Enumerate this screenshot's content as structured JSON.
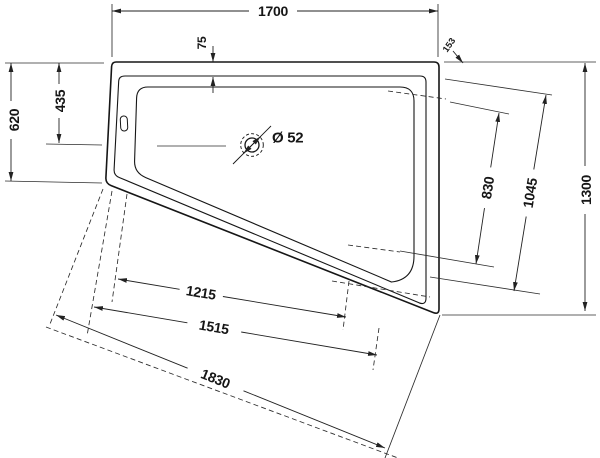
{
  "drawing": {
    "title": "bathtub-plan-technical-drawing",
    "background": "#ffffff",
    "line_color": "#161616",
    "dims": {
      "width_top": "1700",
      "rim_offset": "75",
      "left_edge": "620",
      "drain_offset": "435",
      "right_edge": "1300",
      "panel_right_inner": "830",
      "panel_right_outer": "1045",
      "panel_bottom_inner": "1215",
      "panel_bottom_mid": "1515",
      "panel_bottom_outer": "1830",
      "corner_offset": "153",
      "drain_diameter": "Ø 52"
    }
  }
}
